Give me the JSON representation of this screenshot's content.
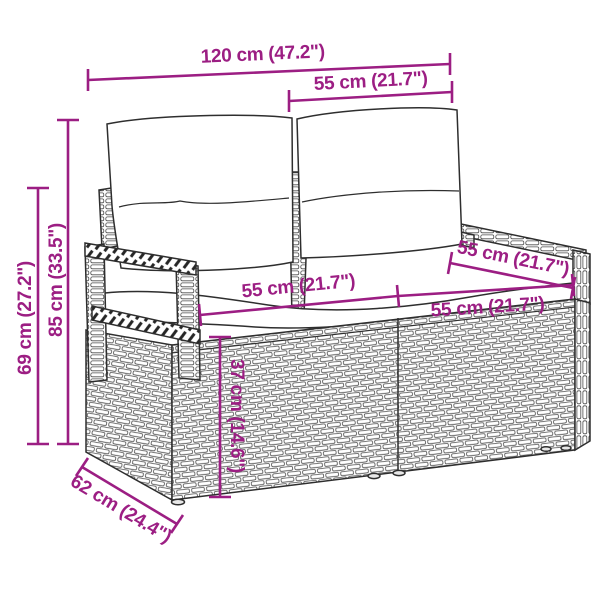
{
  "colors": {
    "accent": "#9C1E83",
    "line_art": "#2e2e2e"
  },
  "diagram": {
    "product": "Poly rattan 2-seater garden sofa with back and seat cushions",
    "measurements": {
      "overall_width": "120 cm (47.2\")",
      "back_cushion_width": "55 cm (21.7\")",
      "overall_height": "85 cm (33.5\")",
      "armrest_height": "69 cm (27.2\")",
      "seat_width_left": "55 cm (21.7\")",
      "seat_width_right": "55 cm (21.7\")",
      "seat_depth": "55 cm (21.7\")",
      "seat_height": "37 cm (14.6\")",
      "overall_depth": "62 cm (24.4\")"
    }
  }
}
